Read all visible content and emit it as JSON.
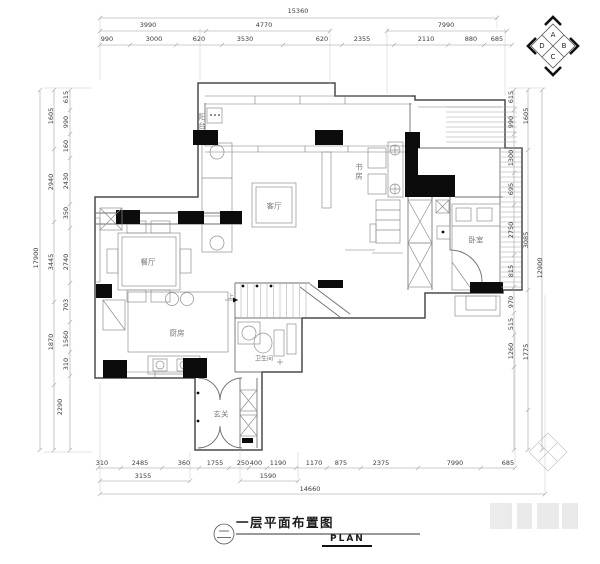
{
  "title_block": {
    "number_symbol": "二",
    "title": "一层平面布置图",
    "subtitle": "PLAN"
  },
  "compass": {
    "labels": [
      "A",
      "B",
      "C",
      "D"
    ]
  },
  "dimensions": {
    "top": {
      "total": "15360",
      "row_mid": [
        "3990",
        "4770",
        "7990"
      ],
      "row_inner": [
        "990",
        "3000",
        "620",
        "3530",
        "620",
        "2355",
        "2110",
        "880",
        "685"
      ]
    },
    "bottom": {
      "row_inner": [
        "310",
        "2485",
        "360",
        "1755",
        "250",
        "400",
        "1190",
        "1170",
        "875",
        "2375",
        "7990",
        "685"
      ],
      "row_mid": [
        "3155",
        "1590"
      ],
      "total": "14660"
    },
    "left": {
      "total": "17900",
      "row_mid": [
        "1605",
        "2940",
        "3445",
        "1870"
      ],
      "row_inner": [
        "615",
        "990",
        "160",
        "2430",
        "350",
        "2740",
        "703",
        "1560",
        "310",
        "2290"
      ]
    },
    "right": {
      "total": "12900",
      "row_mid": [
        "1605",
        "3085",
        "1775"
      ],
      "row_inner": [
        "615",
        "990",
        "1300",
        "695",
        "2750",
        "815",
        "970",
        "515",
        "1260"
      ]
    }
  },
  "rooms": {
    "living": "客厅",
    "dining": "餐厅",
    "kitchen": "厨房",
    "bath": "卫生间",
    "entry": "玄关",
    "bedroom": "卧室",
    "study": "书房",
    "balcony": "阳台",
    "stair_up": "上"
  }
}
